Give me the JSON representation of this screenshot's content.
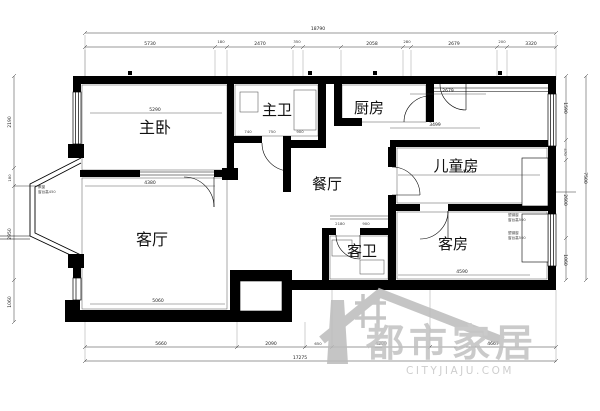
{
  "plan": {
    "rooms": {
      "master_bedroom": "主卧",
      "master_bath": "主卫",
      "kitchen": "厨房",
      "dining": "餐厅",
      "kids_room": "儿童房",
      "living_room": "客厅",
      "guest_bath": "客卫",
      "guest_room": "客房"
    },
    "dims": {
      "top_total": "18790",
      "top_segments": [
        "5730",
        "180",
        "2470",
        "350",
        "2058",
        "280",
        "2679",
        "200",
        "3320"
      ],
      "bottom_segments": [
        "5660",
        "2090",
        "650",
        "4300",
        "4667"
      ],
      "bottom_total": "17275",
      "left_segments": [
        "2190",
        "180",
        "2950",
        "1060"
      ],
      "right_segments": [
        "1590",
        "470",
        "2600",
        "1060"
      ],
      "right_total": "7500",
      "interior": {
        "master_top": "5290",
        "living_top": "4380",
        "living_bottom": "5060",
        "kids_top": "3499",
        "kids_width": "4064",
        "entry_width": "2679",
        "guest_width": "4590",
        "bath_a": "740",
        "bath_b": "750",
        "bath_c": "900",
        "hall_a": "2180",
        "hall_b": "900"
      }
    },
    "annotations": {
      "bay_window_1": "飘窗",
      "bay_window_2": "窗台高450",
      "win_note_1a": "塑钢窗",
      "win_note_1b": "窗台高500",
      "win_note_2a": "塑钢窗",
      "win_note_2b": "窗台高500"
    }
  },
  "watermark": {
    "brand": "都市家居",
    "domain": "CITYJIAJU.COM",
    "color": "#c1c1c1"
  }
}
